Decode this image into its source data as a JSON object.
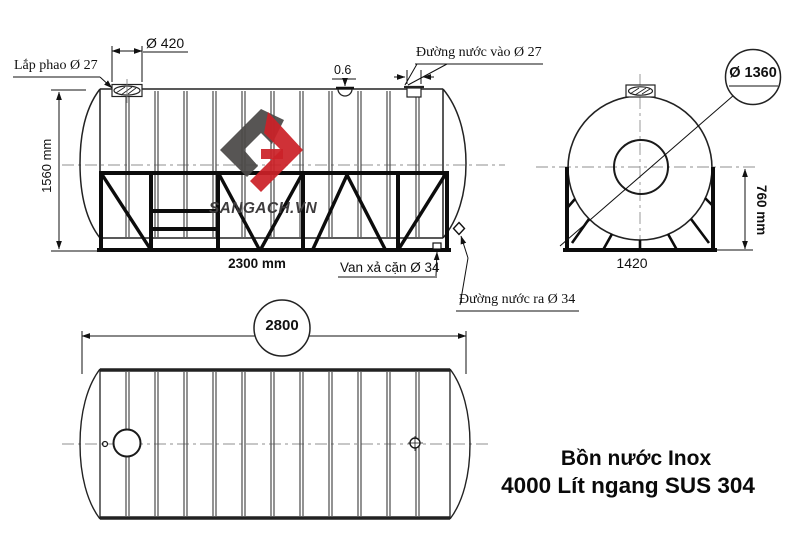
{
  "meta": {
    "background": "#ffffff",
    "line_color": "#1f1f1f",
    "accent_red": "#cb2128",
    "logo_gray": "#4a4847"
  },
  "side_view": {
    "labels": {
      "float_valve": "Lắp phao Ø 27",
      "manhole_diameter": "Ø 420",
      "wall_thickness": "0.6",
      "water_inlet": "Đường nước vào Ø 27",
      "overall_height": "1560 mm",
      "stand_length": "2300 mm",
      "drain_valve": "Van xả cặn Ø 34",
      "water_outlet": "Đường nước ra Ø 34"
    }
  },
  "end_view": {
    "labels": {
      "tank_diameter": "Ø 1360",
      "stand_height": "760 mm",
      "stand_width": "1420"
    }
  },
  "top_view": {
    "labels": {
      "overall_length": "2800"
    }
  },
  "logo": {
    "brand": "SANGACH.VN",
    "monogram": "SG"
  },
  "title": {
    "line1": "Bồn nước Inox",
    "line2": "4000 Lít ngang SUS 304"
  }
}
